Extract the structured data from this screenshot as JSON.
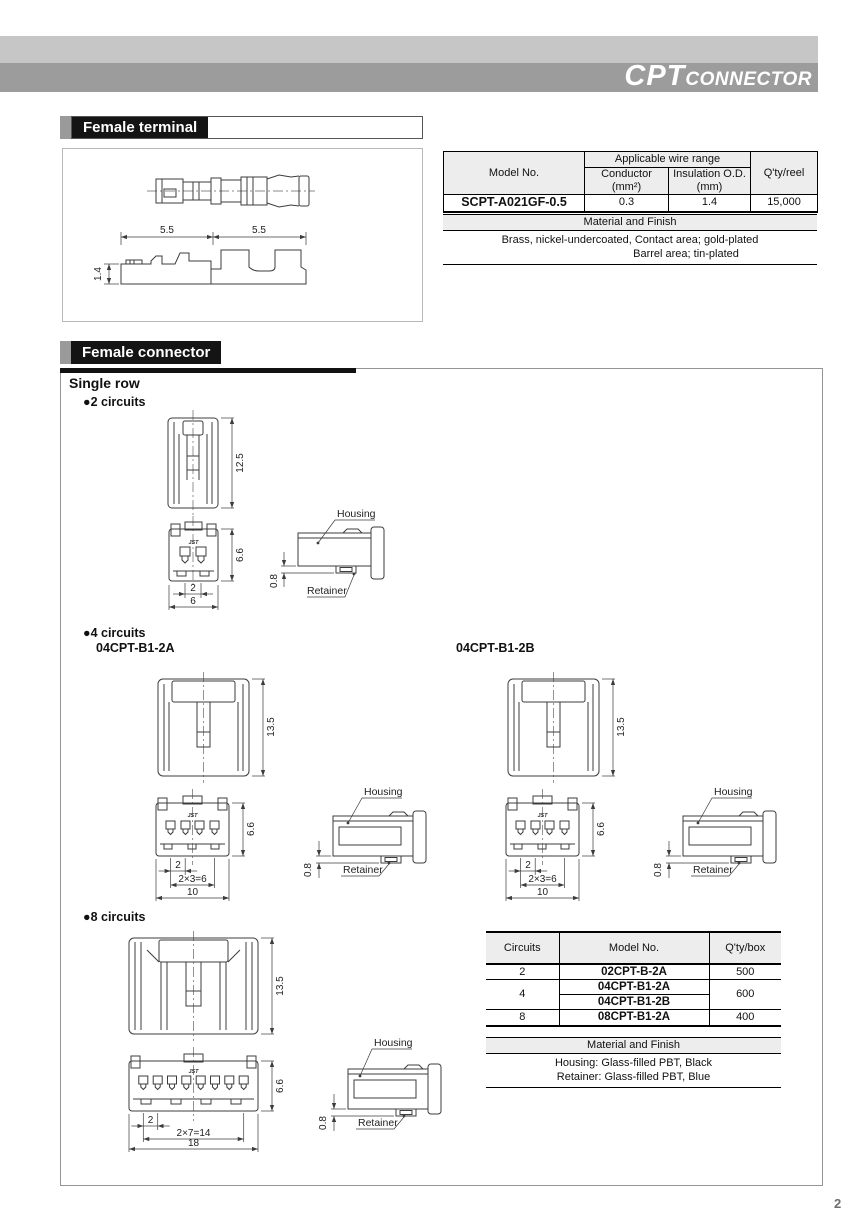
{
  "header": {
    "title_main": "CPT",
    "title_sub": "CONNECTOR"
  },
  "page_number": "2",
  "terminal": {
    "section_title": "Female terminal",
    "dims": {
      "len_left": "5.5",
      "len_right": "5.5",
      "height": "1.4"
    },
    "table": {
      "model_header": "Model No.",
      "wire_header": "Applicable wire range",
      "conductor_l1": "Conductor",
      "conductor_l2": "(mm²)",
      "insulation_l1": "Insulation O.D.",
      "insulation_l2": "(mm)",
      "qty_header": "Q'ty/reel",
      "model": "SCPT-A021GF-0.5",
      "conductor": "0.3",
      "insulation": "1.4",
      "qty": "15,000"
    },
    "material": {
      "title": "Material and Finish",
      "line1": "Brass, nickel-undercoated, Contact area; gold-plated",
      "line2": "Barrel area; tin-plated"
    }
  },
  "connector": {
    "section_title": "Female connector",
    "group_title": "Single row",
    "bullet": "●",
    "c2": {
      "label": "2 circuits",
      "height": "12.5",
      "front_height": "6.6",
      "pitch": "2",
      "width": "6",
      "retainer_dim": "0.8",
      "housing": "Housing",
      "retainer": "Retainer",
      "logo": "JST"
    },
    "c4": {
      "label": "4 circuits",
      "model_a": "04CPT-B1-2A",
      "model_b": "04CPT-B1-2B",
      "height": "13.5",
      "front_height": "6.6",
      "pitch": "2",
      "pitch_total": "2×3=6",
      "width": "10",
      "retainer_dim": "0.8",
      "housing": "Housing",
      "retainer": "Retainer",
      "logo": "JST"
    },
    "c8": {
      "label": "8 circuits",
      "height": "13.5",
      "front_height": "6.6",
      "pitch": "2",
      "pitch_total": "2×7=14",
      "width": "18",
      "retainer_dim": "0.8",
      "housing": "Housing",
      "retainer": "Retainer",
      "logo": "JST"
    },
    "table": {
      "headers": [
        "Circuits",
        "Model No.",
        "Q'ty/box"
      ],
      "rows": [
        {
          "circuits": "2",
          "model": "02CPT-B-2A",
          "qty": "500"
        },
        {
          "circuits": "4",
          "model": "04CPT-B1-2A",
          "qty": "600"
        },
        {
          "circuits": "4",
          "model": "04CPT-B1-2B",
          "qty": "600"
        },
        {
          "circuits": "8",
          "model": "08CPT-B1-2A",
          "qty": "400"
        }
      ],
      "material": {
        "title": "Material and Finish",
        "line1": "Housing: Glass-filled PBT, Black",
        "line2": "Retainer: Glass-filled PBT, Blue"
      }
    }
  },
  "colors": {
    "bar_light": "#c6c6c6",
    "bar_dark": "#9c9c9c",
    "section_black": "#141414",
    "section_gray_square": "#9a9a9a",
    "table_header_bg": "#ededed"
  }
}
